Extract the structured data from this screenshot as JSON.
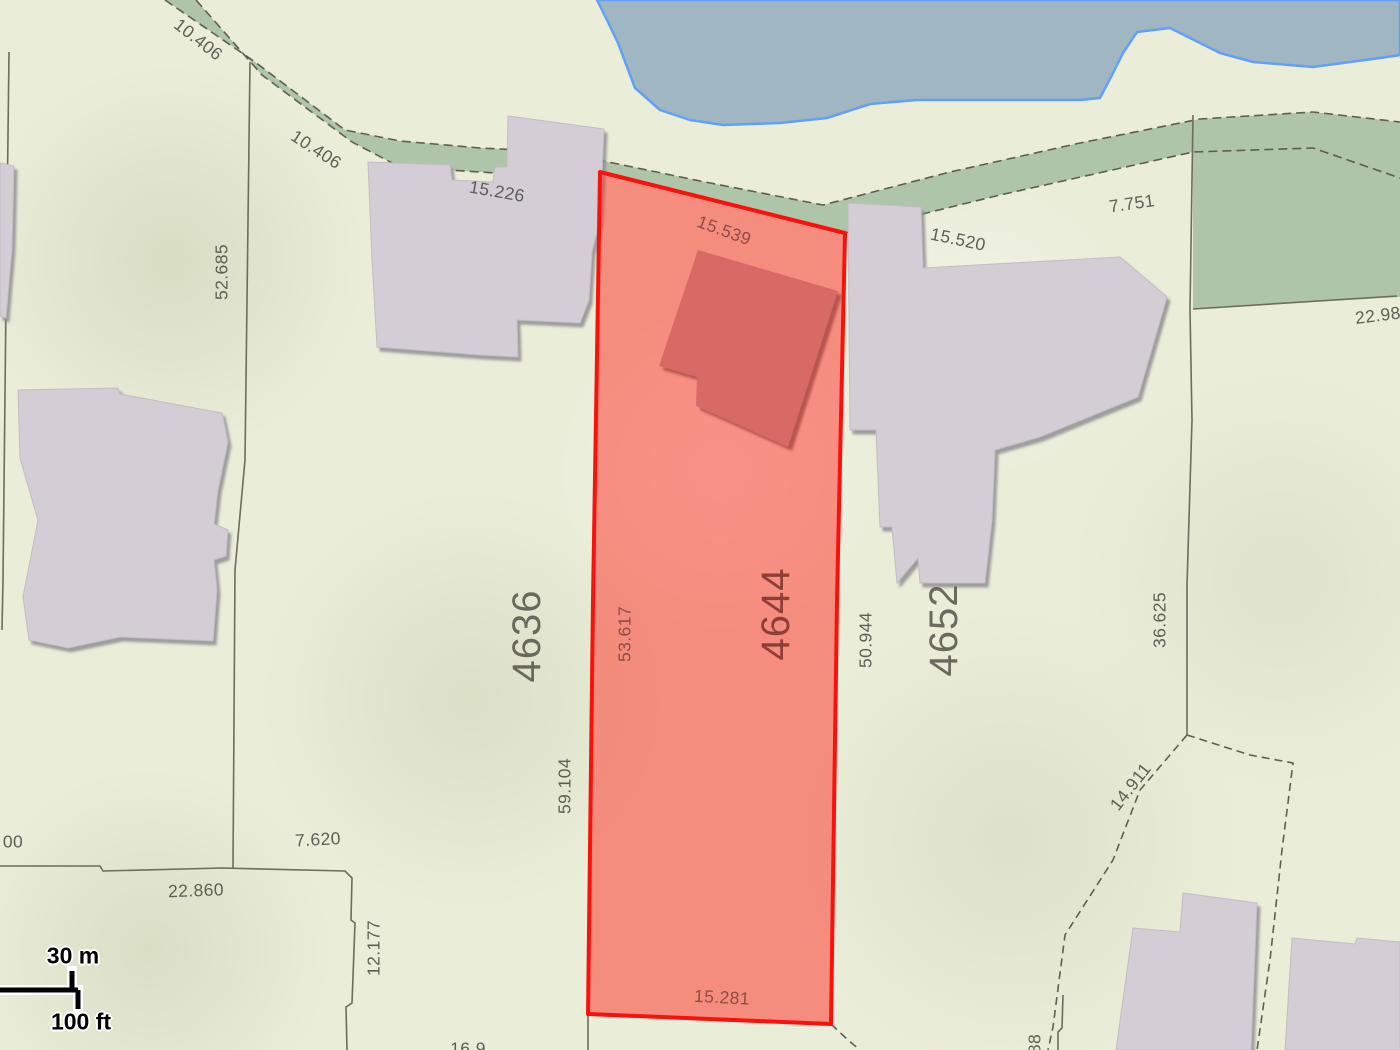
{
  "map": {
    "highlighted_parcel": "4644",
    "parcel_numbers": [
      "4636",
      "4644",
      "4652"
    ],
    "dimension_values": [
      "10.406",
      "10.406",
      "52.685",
      "15.226",
      "15.539",
      "15.520",
      "7.751",
      "22.98",
      "53.617",
      "59.104",
      "50.944",
      "36.625",
      "14.911",
      "7.620",
      "22.860",
      "12.177",
      "15.281",
      "00",
      "88",
      "16.9"
    ]
  },
  "labels": [
    {
      "text": "10.406",
      "x": 198,
      "y": 40,
      "rot": 38,
      "style": "dim"
    },
    {
      "text": "10.406",
      "x": 316,
      "y": 150,
      "rot": 33,
      "style": "dim"
    },
    {
      "text": "52.685",
      "x": 222,
      "y": 272,
      "rot": -90,
      "style": "dim"
    },
    {
      "text": "15.226",
      "x": 497,
      "y": 192,
      "rot": 10,
      "style": "dim"
    },
    {
      "text": "15.539",
      "x": 724,
      "y": 231,
      "rot": 20,
      "style": "dim-red"
    },
    {
      "text": "15.520",
      "x": 958,
      "y": 240,
      "rot": 12,
      "style": "dim"
    },
    {
      "text": "7.751",
      "x": 1132,
      "y": 204,
      "rot": -8,
      "style": "dim"
    },
    {
      "text": "22.98",
      "x": 1378,
      "y": 316,
      "rot": -7,
      "style": "dim"
    },
    {
      "text": "4636",
      "x": 527,
      "y": 636,
      "rot": -90,
      "style": "parcel"
    },
    {
      "text": "53.617",
      "x": 625,
      "y": 634,
      "rot": -90,
      "style": "dim-red"
    },
    {
      "text": "4644",
      "x": 776,
      "y": 614,
      "rot": -90,
      "style": "parcel-red"
    },
    {
      "text": "50.944",
      "x": 866,
      "y": 640,
      "rot": -90,
      "style": "dim"
    },
    {
      "text": "4652",
      "x": 944,
      "y": 630,
      "rot": -90,
      "style": "parcel"
    },
    {
      "text": "36.625",
      "x": 1160,
      "y": 620,
      "rot": -90,
      "style": "dim"
    },
    {
      "text": "59.104",
      "x": 565,
      "y": 786,
      "rot": -90,
      "style": "dim"
    },
    {
      "text": "14.911",
      "x": 1131,
      "y": 787,
      "rot": -52,
      "style": "dim"
    },
    {
      "text": "7.620",
      "x": 318,
      "y": 840,
      "rot": -3,
      "style": "dim"
    },
    {
      "text": "22.860",
      "x": 196,
      "y": 891,
      "rot": -2,
      "style": "dim"
    },
    {
      "text": "12.177",
      "x": 374,
      "y": 948,
      "rot": -90,
      "style": "dim"
    },
    {
      "text": "15.281",
      "x": 722,
      "y": 998,
      "rot": 3,
      "style": "dim-red"
    },
    {
      "text": "00",
      "x": 13,
      "y": 842,
      "rot": 0,
      "style": "dim"
    },
    {
      "text": "88",
      "x": 1035,
      "y": 1044,
      "rot": -90,
      "style": "dim"
    },
    {
      "text": "16.9",
      "x": 468,
      "y": 1049,
      "rot": 0,
      "style": "dim"
    }
  ],
  "scale_bar": {
    "meters_label": "30 m",
    "feet_label": "100 ft"
  },
  "colors": {
    "land": "#eaedd8",
    "water_fill": "#a0b6c2",
    "water_stroke": "#63a0f5",
    "greenway": "#aec5a9",
    "building_fill": "#d5cdd6",
    "building_shadow": "#8f8f92",
    "highlight_fill": "rgba(255,45,38,0.5)",
    "highlight_stroke": "#fb100c",
    "highlight_building": "#d76b65",
    "boundary_line": "#6d6c5e",
    "label_text": "#55544b",
    "label_text_on_red": "#8a4840"
  }
}
